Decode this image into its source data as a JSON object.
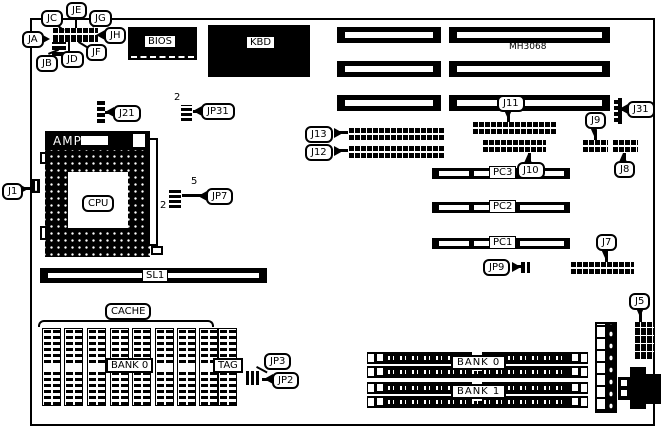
{
  "board": {
    "chipset_label": "MH3068"
  },
  "chips": {
    "bios": "BIOS",
    "kbd": "KBD",
    "amp": "AMP",
    "cpu": "CPU"
  },
  "slots": {
    "sl1": "SL1",
    "pc3": "PC3",
    "pc2": "PC2",
    "pc1": "PC1"
  },
  "memory": {
    "cache_title": "CACHE",
    "cache_bank_label": "BANK 0",
    "tag_label": "TAG",
    "simm_bank0_label": "BANK 0",
    "simm_bank1_label": "BANK 1"
  },
  "callouts": {
    "ja": "JA",
    "jb": "JB",
    "jc": "JC",
    "jd": "JD",
    "je": "JE",
    "jf": "JF",
    "jg": "JG",
    "jh": "JH",
    "j1": "J1",
    "j21": "J21",
    "jp31": "JP31",
    "jp7": "JP7",
    "j31": "J31",
    "j11": "J11",
    "j13": "J13",
    "j12": "J12",
    "j10": "J10",
    "j9": "J9",
    "j8": "J8",
    "j7": "J7",
    "jp9": "JP9",
    "j5": "J5",
    "jp3": "JP3",
    "jp2": "JP2"
  },
  "pin_numbers": {
    "jp31_pin2": "2",
    "jp7_pin5": "5",
    "jp7_pin2": "2"
  }
}
